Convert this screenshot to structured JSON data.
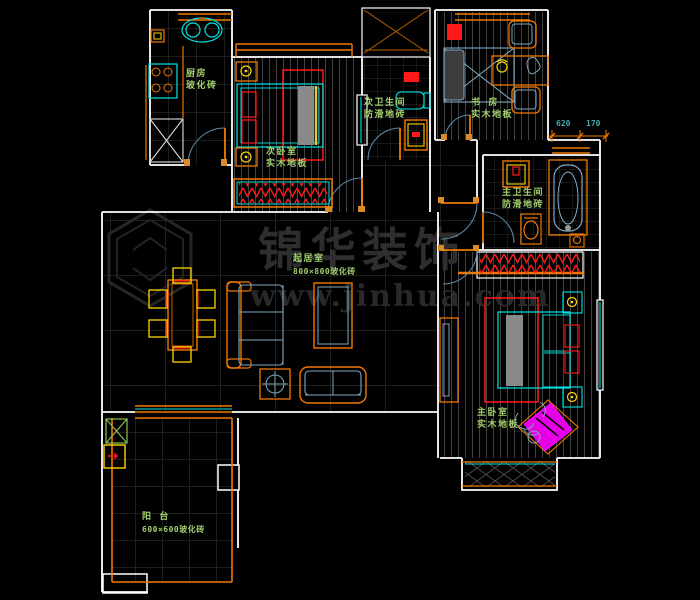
{
  "app": {
    "type": "cad-floor-plan"
  },
  "rooms": [
    {
      "id": "kitchen",
      "name": "厨房",
      "floor": "玻化砖"
    },
    {
      "id": "secondary-bedroom",
      "name": "次卧室",
      "floor": "实木地板"
    },
    {
      "id": "secondary-bathroom",
      "name": "次卫生间",
      "floor": "防滑地砖"
    },
    {
      "id": "study",
      "name": "书 房",
      "floor": "实木地板"
    },
    {
      "id": "master-bathroom",
      "name": "主卫生间",
      "floor": "防滑地砖"
    },
    {
      "id": "living-room",
      "name": "起居室",
      "floor": "800×800玻化砖"
    },
    {
      "id": "master-bedroom",
      "name": "主卧室",
      "floor": "实木地板"
    },
    {
      "id": "balcony",
      "name": "阳 台",
      "floor": "600×600玻化砖"
    }
  ],
  "dims": {
    "d1": "620",
    "d2": "170"
  },
  "watermark": {
    "brand": "锦华装饰",
    "url": "www.jinhua.com"
  },
  "colors": {
    "wall": "#FFFFFF",
    "accent_orange": "#F07800",
    "fixture_cyan": "#00E5E5",
    "furniture_blue": "#7FA8C0",
    "highlight_yellow": "#FFD400",
    "alert_red": "#FF1A1A",
    "label_green": "#A3D06E",
    "dim_text": "#3FA9A9",
    "chair_magenta": "#FF00FF",
    "background": "#000000"
  }
}
